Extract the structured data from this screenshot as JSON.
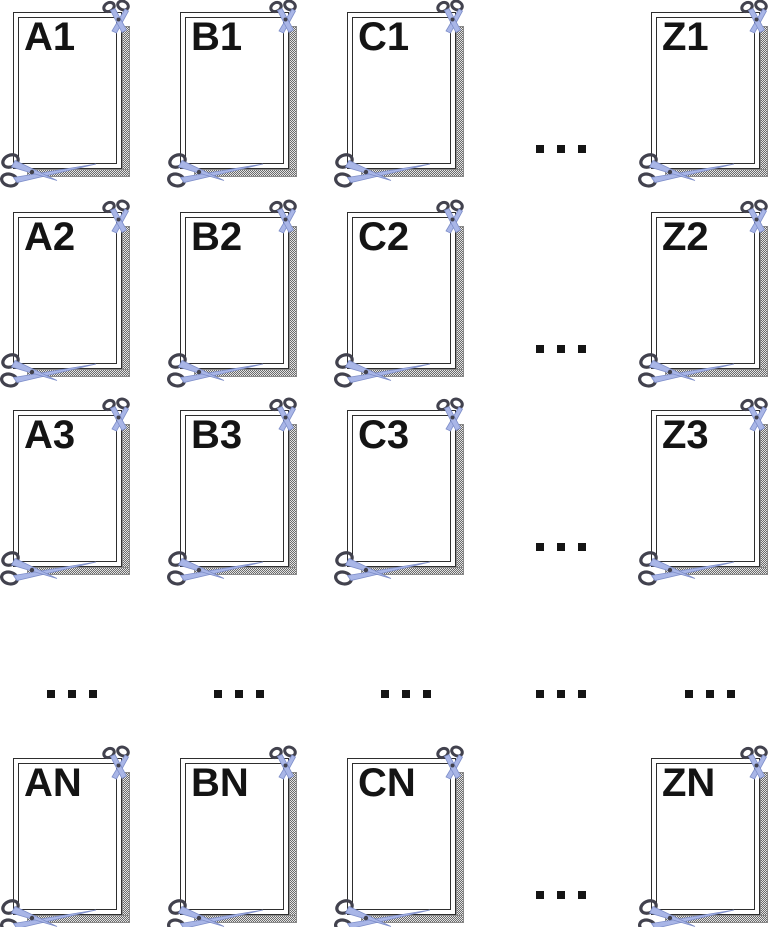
{
  "grid": {
    "rows": [
      [
        "A1",
        "B1",
        "C1",
        "Z1"
      ],
      [
        "A2",
        "B2",
        "C2",
        "Z2"
      ],
      [
        "A3",
        "B3",
        "C3",
        "Z3"
      ],
      [
        "AN",
        "BN",
        "CN",
        "ZN"
      ]
    ],
    "row_gap_ellipsis_count": 4,
    "column_gap_ellipsis_count": 5
  },
  "ellipsis": {
    "dot_count": 3
  },
  "icons": {
    "card_top_right": "scissors-icon",
    "card_bottom_left": "scissors-icon"
  },
  "colors": {
    "background": "#ffffff",
    "frame_border": "#2e2e2e",
    "label_text": "#141414",
    "cut_strip_dark": "#6b6b6b",
    "cut_strip_light": "#e3e3e3",
    "scissors_handle": "#42424e",
    "scissors_blade_fill": "#a9b6e7",
    "scissors_blade_edge": "#7e8ec9"
  }
}
